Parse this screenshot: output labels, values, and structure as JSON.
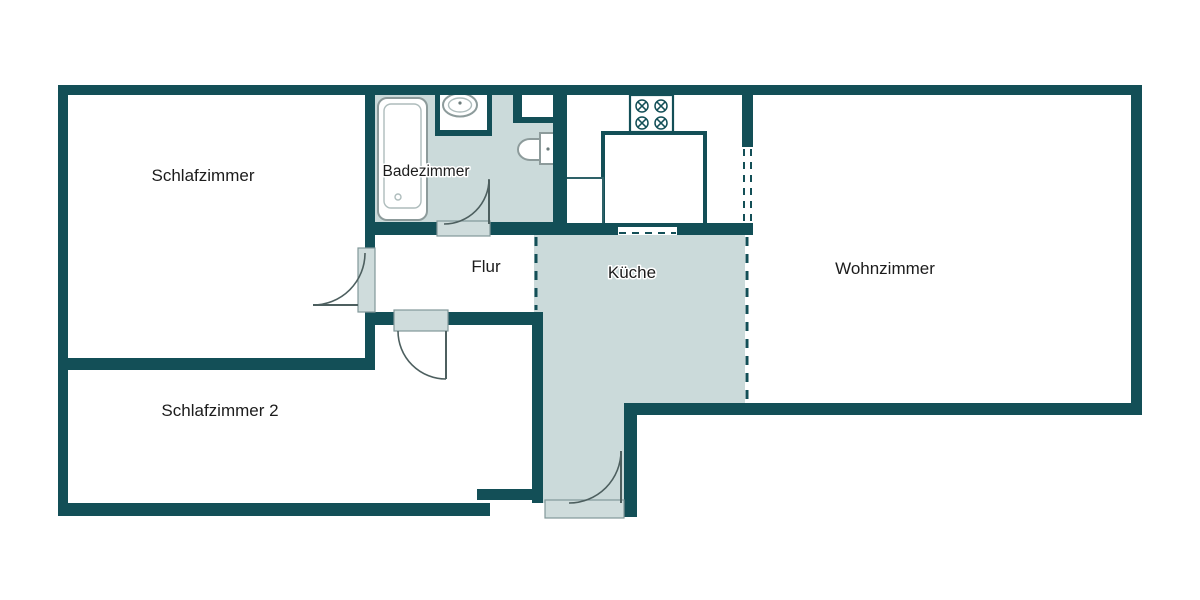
{
  "plan": {
    "type": "apartment-floor-plan",
    "rooms": [
      {
        "id": "schlafzimmer",
        "label": "Schlafzimmer",
        "shaded": false
      },
      {
        "id": "badezimmer",
        "label": "Badezimmer",
        "shaded": true
      },
      {
        "id": "flur",
        "label": "Flur",
        "shaded": false
      },
      {
        "id": "kueche",
        "label": "Küche",
        "shaded": true
      },
      {
        "id": "wohnzimmer",
        "label": "Wohnzimmer",
        "shaded": false
      },
      {
        "id": "schlafzimmer2",
        "label": "Schlafzimmer 2",
        "shaded": false
      }
    ],
    "fixtures": [
      {
        "name": "bathtub-icon"
      },
      {
        "name": "washbasin-icon"
      },
      {
        "name": "toilet-icon"
      },
      {
        "name": "stove-four-burners-icon"
      },
      {
        "name": "kitchen-counter-icon"
      },
      {
        "name": "kitchen-cabinet-icon"
      }
    ],
    "doors": [
      {
        "name": "schlafzimmer-door"
      },
      {
        "name": "badezimmer-door"
      },
      {
        "name": "schlafzimmer2-door"
      },
      {
        "name": "entrance-door"
      }
    ],
    "open-passages": [
      {
        "name": "kueche-wohnzimmer-dashed-divider"
      },
      {
        "name": "flur-kueche-dashed-divider"
      },
      {
        "name": "kueche-passage-opening"
      },
      {
        "name": "kueche-wohnzimmer-wall-opening"
      }
    ]
  },
  "colors": {
    "wall": "#134f57",
    "room_fill": "#cbdada",
    "threshold_fill": "#cfdcdc",
    "threshold_border": "#82989a",
    "door_arc": "#4d5f5f",
    "fixture_outline": "#8d9b9b",
    "label_text": "#1c1c1c",
    "page_bg": "#ffffff"
  }
}
